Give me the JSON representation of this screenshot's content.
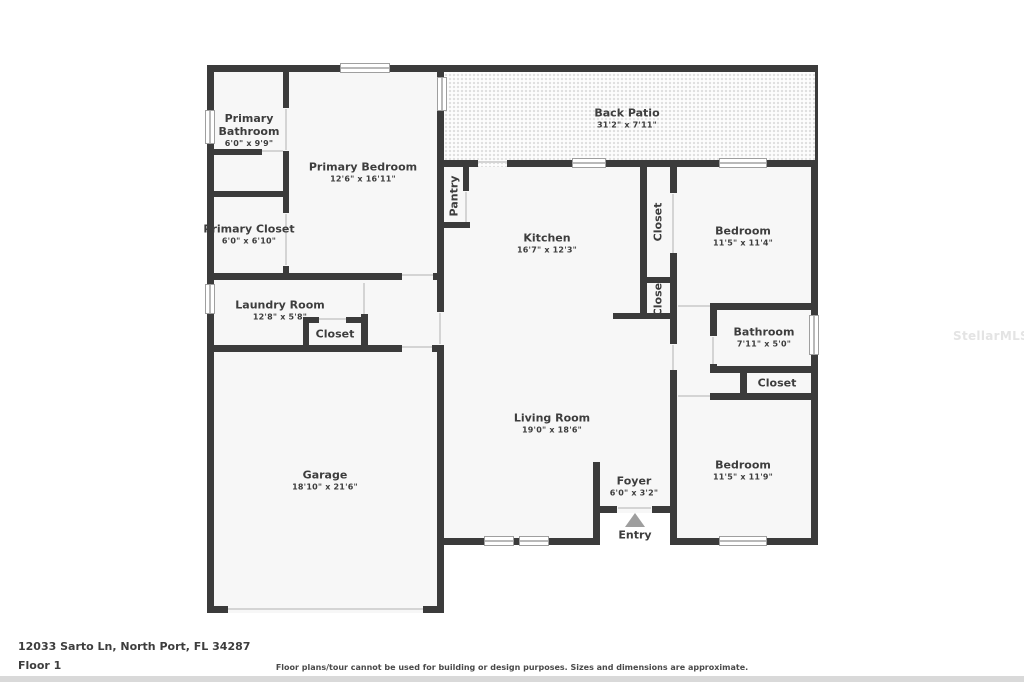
{
  "plan": {
    "rooms": {
      "primary_bathroom": {
        "name": "Primary Bathroom",
        "dims": "6'0\" x 9'9\""
      },
      "primary_bedroom": {
        "name": "Primary Bedroom",
        "dims": "12'6\" x 16'11\""
      },
      "primary_closet": {
        "name": "Primary Closet",
        "dims": "6'0\" x 6'10\""
      },
      "back_patio": {
        "name": "Back Patio",
        "dims": "31'2\" x 7'11\""
      },
      "pantry": {
        "name": "Pantry"
      },
      "kitchen": {
        "name": "Kitchen",
        "dims": "16'7\" x 12'3\""
      },
      "closet_hall_upper": {
        "name": "Closet"
      },
      "closet_hall_lower": {
        "name": "Closet"
      },
      "bedroom_upper": {
        "name": "Bedroom",
        "dims": "11'5\" x 11'4\""
      },
      "laundry_room": {
        "name": "Laundry Room",
        "dims": "12'8\" x 5'8\""
      },
      "closet_laundry": {
        "name": "Closet"
      },
      "garage": {
        "name": "Garage",
        "dims": "18'10\" x 21'6\""
      },
      "living_room": {
        "name": "Living Room",
        "dims": "19'0\" x 18'6\""
      },
      "bathroom": {
        "name": "Bathroom",
        "dims": "7'11\" x 5'0\""
      },
      "closet_bedroom2": {
        "name": "Closet"
      },
      "bedroom_lower": {
        "name": "Bedroom",
        "dims": "11'5\" x 11'9\""
      },
      "foyer": {
        "name": "Foyer",
        "dims": "6'0\" x 3'2\""
      },
      "entry": {
        "name": "Entry"
      }
    }
  },
  "footer": {
    "address": "12033 Sarto Ln, North Port, FL 34287",
    "floor": "Floor 1",
    "disclaimer": "Floor plans/tour cannot be used for building or design purposes. Sizes and dimensions are approximate."
  },
  "watermark": "StellarMLS",
  "colors": {
    "wall": "#3b3b3b",
    "room_fill": "#f7f7f7",
    "text": "#3d3d3d",
    "entry_arrow": "#9e9e9e",
    "patio_dot": "#e0e0e0",
    "footer_bar": "#d9d9d9"
  }
}
